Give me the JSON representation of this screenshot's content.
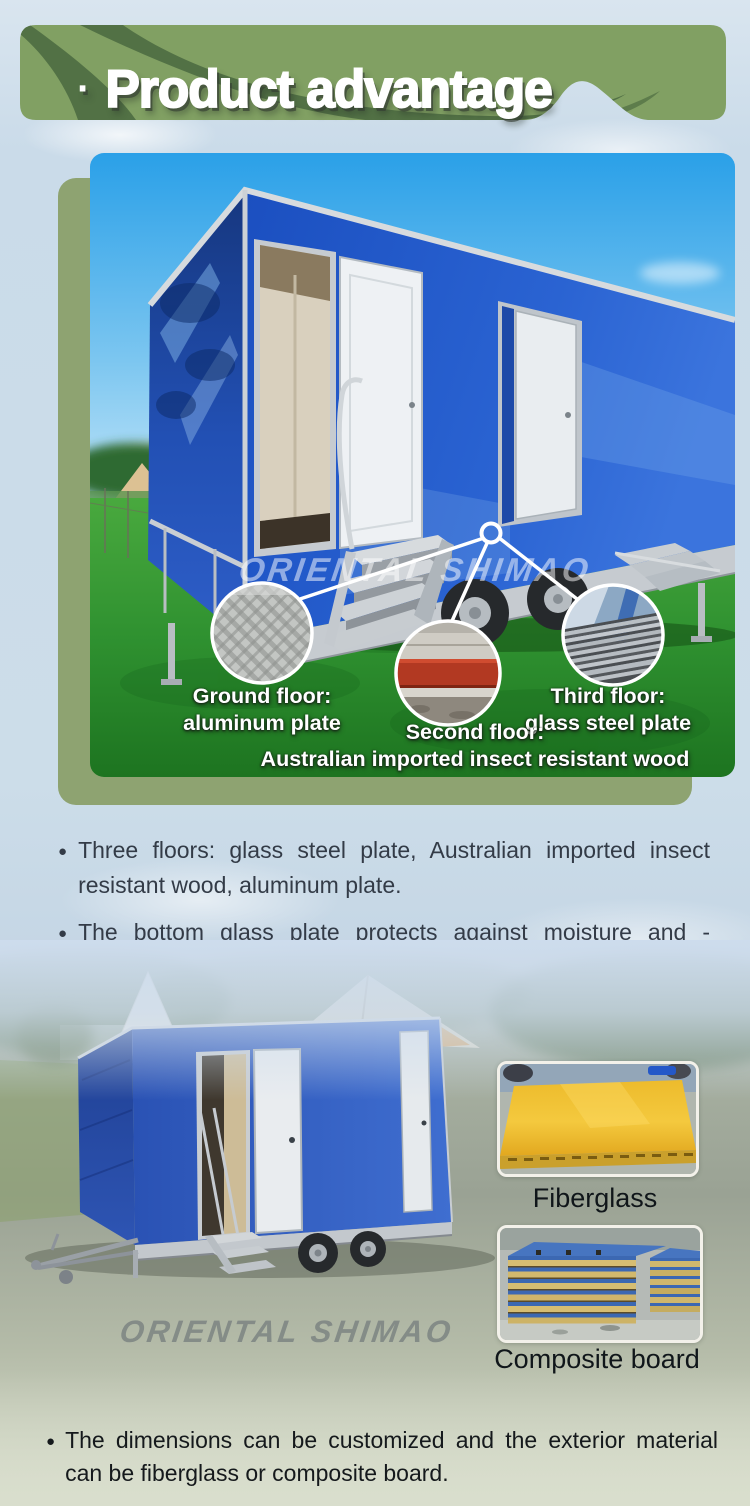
{
  "header": {
    "bullet": "·",
    "title": "Product advantage"
  },
  "main_figure": {
    "watermark": "ORIENTAL SHIMAO",
    "callouts": [
      {
        "title": "Ground floor:",
        "subtitle": "aluminum plate"
      },
      {
        "title": "Second floor:",
        "subtitle": "Australian imported insect resistant wood"
      },
      {
        "title": "Third floor:",
        "subtitle": "glass steel plate"
      }
    ]
  },
  "bullets": [
    "Three floors: glass steel plate, Australian imported insect resistant wood, aluminum plate.",
    "The bottom glass plate protects against moisture and -insects."
  ],
  "materials": {
    "watermark": "ORIENTAL SHIMAO",
    "items": [
      {
        "label": "Fiberglass"
      },
      {
        "label": "Composite board"
      }
    ]
  },
  "footer": {
    "text": "The dimensions can be customized and the exterior material can be fiberglass or composite board."
  },
  "colors": {
    "banner_green": "#81a063",
    "swoosh_green": "#4e6c42",
    "card_green": "#8ea371",
    "trailer_blue": "#2b57b8",
    "sky_blue": "#2aa0e8",
    "grass_green": "#2f9130",
    "fiberglass_yellow": "#eebd2e",
    "text_dark": "#333b47"
  }
}
